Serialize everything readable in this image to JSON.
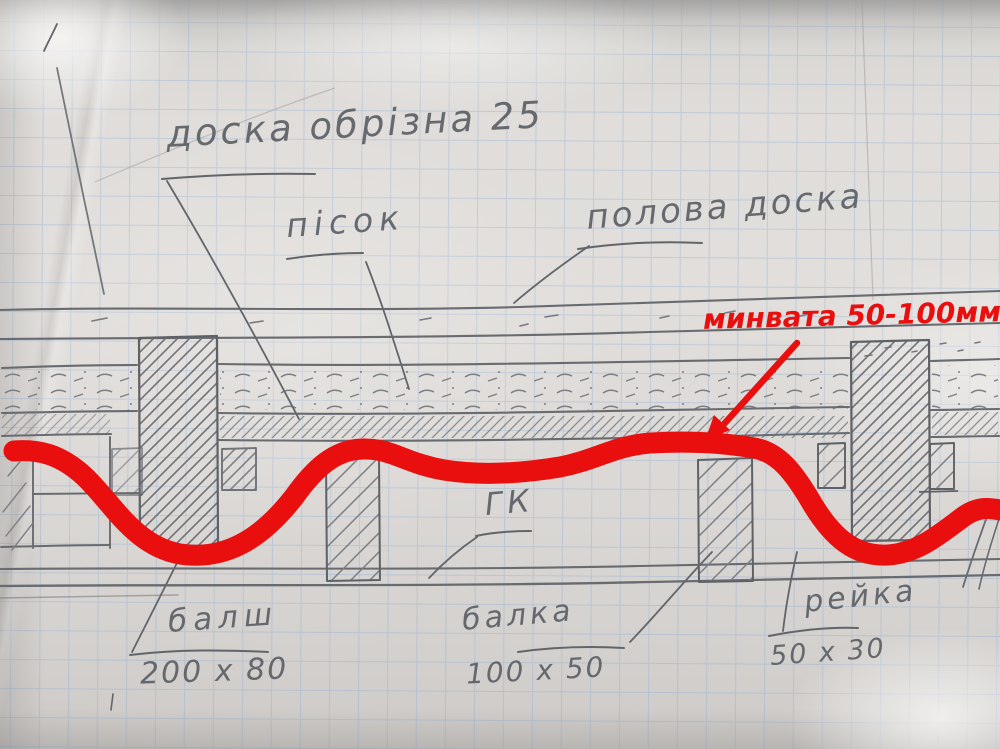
{
  "annotations": {
    "edged_board": "доска обрізна 25",
    "sand": "пісок",
    "floor_board": "полова доска",
    "mineral_wool": "минвата 50-100мм",
    "gypsum_board": "ГК",
    "large_beam": "балш",
    "large_beam_size": "200 x 80",
    "mid_beam": "балка",
    "mid_beam_size": "100 x 50",
    "batten": "рейка",
    "batten_size": "50 x 30"
  },
  "colors": {
    "marker-red": "#ea0f0f",
    "grid-blue": "#8fb0d8",
    "pencil-gray": "#686b70",
    "paper": "#dedbd8"
  }
}
